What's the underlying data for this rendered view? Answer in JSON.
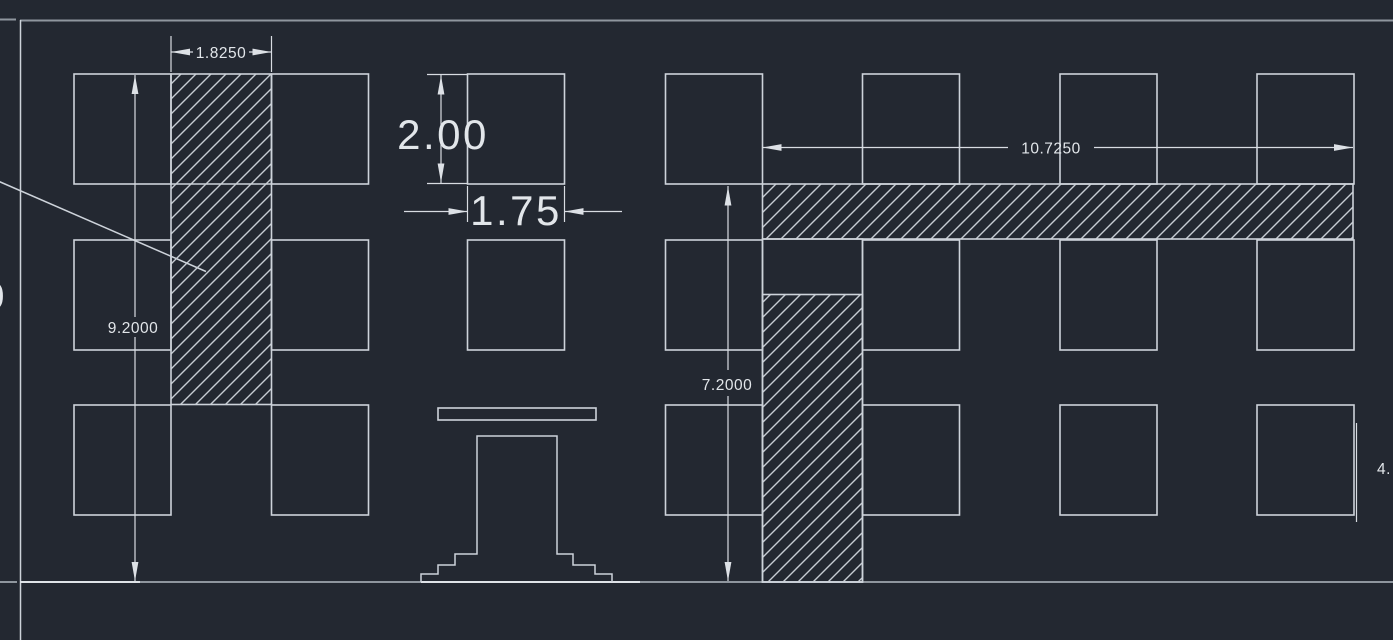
{
  "canvas": {
    "type": "cad-drawing-canvas",
    "view": "wall-elevation-with-section-hatching",
    "background": "#232831"
  },
  "colors": {
    "background": "#232831",
    "entity_line": "#cdd3da",
    "dimension_line": "#d8dce2",
    "dimension_text": "#e2e6ea",
    "muted_border_line": "#8f969e",
    "hatch_line": "#c6ccd3"
  },
  "dimensions": {
    "pier_width": {
      "label": "1.8250"
    },
    "opening_height": {
      "label": "2.00"
    },
    "opening_width": {
      "label": "1.75"
    },
    "wall_height": {
      "label": "9.2000"
    },
    "band_length": {
      "label": "10.7250"
    },
    "right_wall_height": {
      "label": "7.2000"
    },
    "clipped_right": {
      "label": "4."
    },
    "clipped_left": {
      "label": "0"
    }
  }
}
